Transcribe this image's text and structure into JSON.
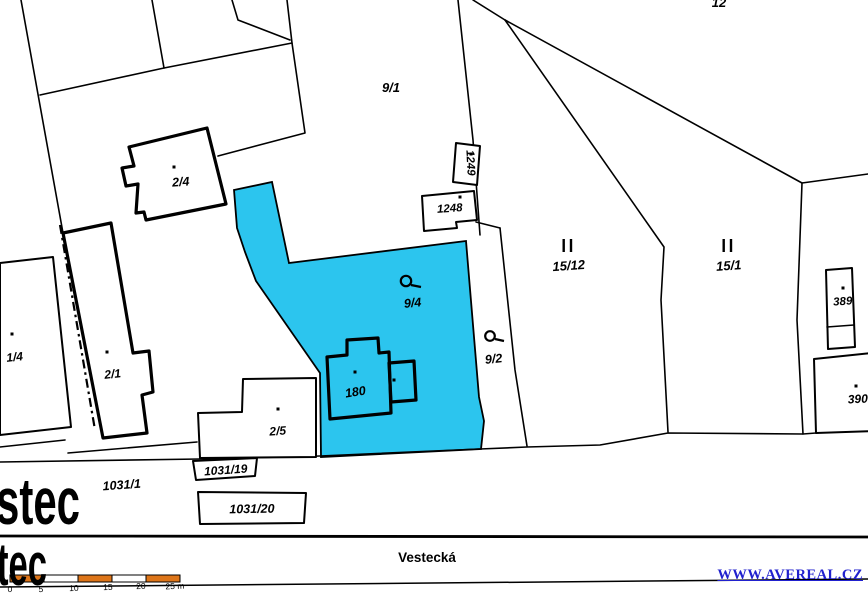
{
  "title": "Cadastral map with highlighted parcel",
  "colors": {
    "highlight_cyan": "#2CC5EE",
    "scale_orange": "#DD7519",
    "link_blue": "#2121CE",
    "line_black": "#000000"
  },
  "watermark": {
    "text": "WWW.AVEREAL.CZ"
  },
  "street": {
    "name": "Vestecká"
  },
  "town_label": {
    "top_fragment": "stec",
    "bottom_fragment": "tec"
  },
  "scale_bar": {
    "tick_labels": [
      "0",
      "5",
      "10",
      "15",
      "20",
      "25 m"
    ],
    "segments": 5,
    "units": "m"
  },
  "highlighted_parcel": "9/4",
  "parcel_numbers": [
    "9/1",
    "12",
    "2/4",
    "1249",
    "1248",
    "15/12",
    "15/1",
    "389",
    "390",
    "1/4",
    "2/1",
    "9/4",
    "9/2",
    "180",
    "2/5",
    "1031/19",
    "1031/1",
    "1031/20"
  ],
  "labels": [
    {
      "name": "parcel-label-9-1",
      "text": "9/1",
      "x": 391,
      "y": 92,
      "size": 13,
      "rot": 0,
      "cls": "lbl",
      "anchor": "middle"
    },
    {
      "name": "parcel-label-12",
      "text": "12",
      "x": 719,
      "y": 7,
      "size": 13,
      "rot": 0,
      "cls": "lbl",
      "anchor": "middle"
    },
    {
      "name": "parcel-label-2-4",
      "text": "2/4",
      "x": 181,
      "y": 186,
      "size": 12.5,
      "rot": -4,
      "cls": "lbl",
      "anchor": "middle"
    },
    {
      "name": "parcel-label-1249",
      "text": "1249",
      "x": 467,
      "y": 163,
      "size": 11.5,
      "rot": 87,
      "cls": "lbl",
      "anchor": "middle"
    },
    {
      "name": "parcel-label-1248",
      "text": "1248",
      "x": 450,
      "y": 212,
      "size": 11.5,
      "rot": -4,
      "cls": "lbl",
      "anchor": "middle"
    },
    {
      "name": "parcel-label-15-12",
      "text": "15/12",
      "x": 569,
      "y": 270,
      "size": 13,
      "rot": -4,
      "cls": "lbl",
      "anchor": "middle"
    },
    {
      "name": "parcel-label-15-1",
      "text": "15/1",
      "x": 729,
      "y": 270,
      "size": 13,
      "rot": -4,
      "cls": "lbl",
      "anchor": "middle"
    },
    {
      "name": "parcel-label-389",
      "text": "389",
      "x": 843,
      "y": 305,
      "size": 11.5,
      "rot": -4,
      "cls": "lbl",
      "anchor": "middle"
    },
    {
      "name": "parcel-label-390",
      "text": "390",
      "x": 858,
      "y": 403,
      "size": 12,
      "rot": -3,
      "cls": "lbl",
      "anchor": "middle"
    },
    {
      "name": "parcel-label-1-4",
      "text": "1/4",
      "x": 15,
      "y": 361,
      "size": 12,
      "rot": -6,
      "cls": "lbl",
      "anchor": "middle"
    },
    {
      "name": "parcel-label-2-1",
      "text": "2/1",
      "x": 113,
      "y": 378,
      "size": 12,
      "rot": -6,
      "cls": "lbl",
      "anchor": "middle"
    },
    {
      "name": "parcel-label-9-4",
      "text": "9/4",
      "x": 413,
      "y": 307,
      "size": 12.5,
      "rot": -6,
      "cls": "lbl",
      "anchor": "middle"
    },
    {
      "name": "parcel-label-9-2",
      "text": "9/2",
      "x": 494,
      "y": 363,
      "size": 12.5,
      "rot": -6,
      "cls": "lbl",
      "anchor": "middle"
    },
    {
      "name": "parcel-label-180",
      "text": "180",
      "x": 356,
      "y": 396,
      "size": 12.5,
      "rot": -9,
      "cls": "lbl",
      "anchor": "middle"
    },
    {
      "name": "parcel-label-2-5",
      "text": "2/5",
      "x": 278,
      "y": 435,
      "size": 12,
      "rot": -4,
      "cls": "lbl",
      "anchor": "middle"
    },
    {
      "name": "parcel-label-1031-19",
      "text": "1031/19",
      "x": 226,
      "y": 474,
      "size": 12,
      "rot": -4,
      "cls": "lbl",
      "anchor": "middle"
    },
    {
      "name": "parcel-label-1031-1",
      "text": "1031/1",
      "x": 122,
      "y": 489,
      "size": 12.5,
      "rot": -4,
      "cls": "lbl",
      "anchor": "middle"
    },
    {
      "name": "parcel-label-1031-20",
      "text": "1031/20",
      "x": 252,
      "y": 513,
      "size": 12.5,
      "rot": -1,
      "cls": "lbl",
      "anchor": "middle"
    },
    {
      "name": "street-name-label",
      "text": "Vestecká",
      "x": 427,
      "y": 562,
      "size": 13.5,
      "rot": 0,
      "cls": "street",
      "anchor": "middle"
    },
    {
      "name": "town-name-top",
      "text": "stec",
      "x": -4,
      "y": 524,
      "size": 66,
      "rot": 0,
      "cls": "big",
      "anchor": "start",
      "len": 84
    },
    {
      "name": "town-name-bottom",
      "text": "tec",
      "x": -3,
      "y": 585,
      "size": 60,
      "rot": 0,
      "cls": "big",
      "anchor": "start",
      "len": 50
    },
    {
      "name": "scale-tick-0",
      "text": "0",
      "x": 10,
      "y": 592,
      "size": 8.5,
      "rot": -2,
      "cls": "scale",
      "anchor": "middle"
    },
    {
      "name": "scale-tick-5",
      "text": "5",
      "x": 41,
      "y": 592,
      "size": 8.5,
      "rot": -2,
      "cls": "scale",
      "anchor": "middle"
    },
    {
      "name": "scale-tick-10",
      "text": "10",
      "x": 74,
      "y": 591,
      "size": 8.5,
      "rot": -2,
      "cls": "scale",
      "anchor": "middle"
    },
    {
      "name": "scale-tick-15",
      "text": "15",
      "x": 108,
      "y": 590,
      "size": 8.5,
      "rot": -2,
      "cls": "scale",
      "anchor": "middle"
    },
    {
      "name": "scale-tick-20",
      "text": "20",
      "x": 141,
      "y": 589,
      "size": 8.5,
      "rot": -2,
      "cls": "scale",
      "anchor": "middle"
    },
    {
      "name": "scale-tick-25m",
      "text": "25 m",
      "x": 175,
      "y": 589,
      "size": 8.5,
      "rot": -2,
      "cls": "scale",
      "anchor": "middle"
    }
  ]
}
